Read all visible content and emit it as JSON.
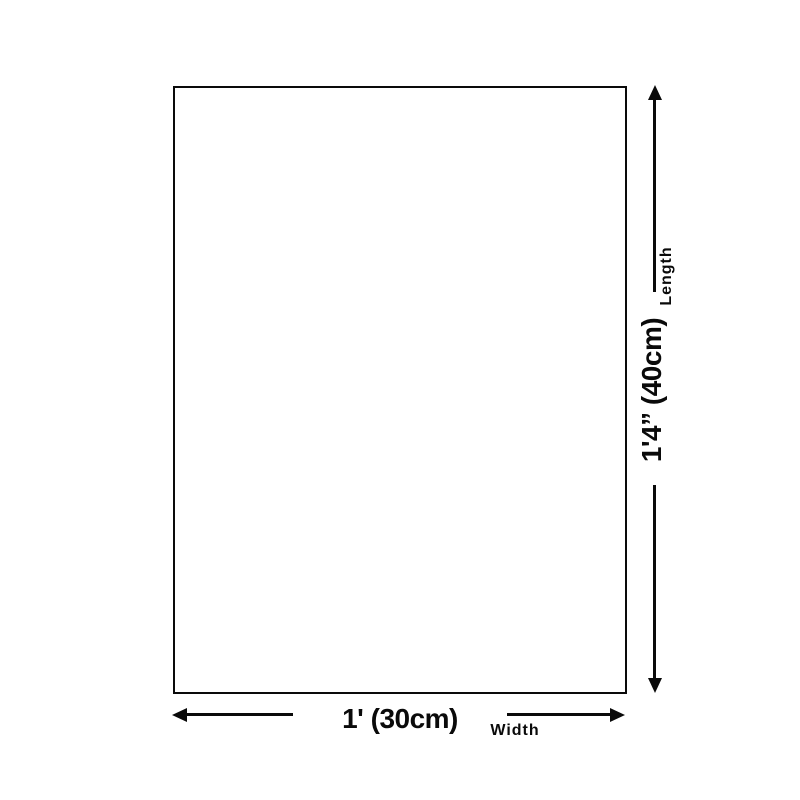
{
  "diagram": {
    "type": "product-dimension-diagram",
    "colors": {
      "line": "#0a0a0a",
      "background": "#ffffff"
    },
    "length": {
      "value": "1'4” (40cm)",
      "label": "Length"
    },
    "width": {
      "value": "1' (30cm)",
      "label": "Width"
    }
  }
}
